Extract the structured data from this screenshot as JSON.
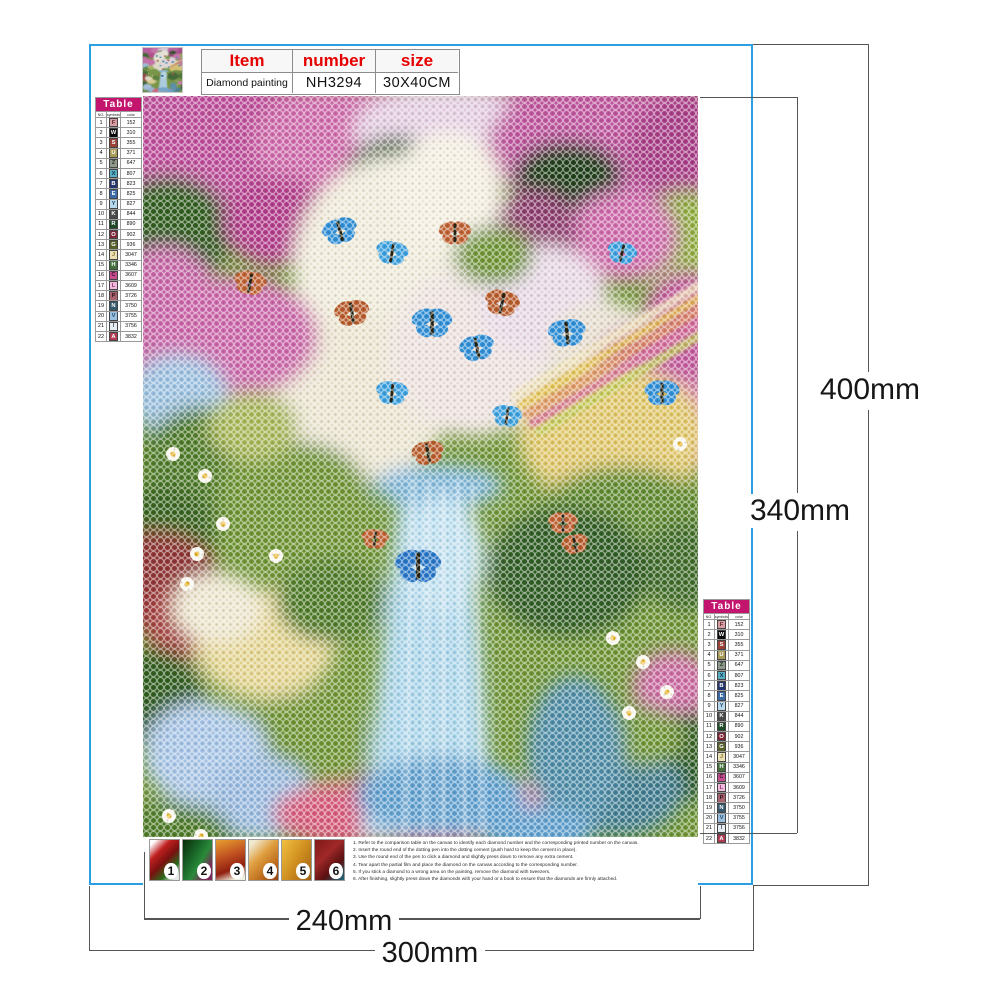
{
  "colors": {
    "border_blue": "#2b9fe2",
    "table_magenta": "#c4156e",
    "spec_red": "#e60000"
  },
  "spec_table": {
    "headers": {
      "item": "Item",
      "number": "number",
      "size": "size"
    },
    "values": {
      "item": "Diamond painting",
      "number": "NH3294",
      "size": "30X40CM"
    }
  },
  "color_table": {
    "title": "Table",
    "col_headers": {
      "no": "NO.",
      "symbols": "symbols",
      "color": "color"
    },
    "rows": [
      {
        "no": "1",
        "symbol": "F",
        "code": "152",
        "bg": "#d89ea4",
        "fg": "#5d2a32"
      },
      {
        "no": "2",
        "symbol": "W",
        "code": "310",
        "bg": "#0a0a0a",
        "fg": "#ffffff"
      },
      {
        "no": "3",
        "symbol": "S",
        "code": "355",
        "bg": "#9a4238",
        "fg": "#ffffff"
      },
      {
        "no": "4",
        "symbol": "U",
        "code": "371",
        "bg": "#a89a55",
        "fg": "#ffffff"
      },
      {
        "no": "5",
        "symbol": "Z",
        "code": "647",
        "bg": "#8f9a8c",
        "fg": "#2f3a2f"
      },
      {
        "no": "6",
        "symbol": "X",
        "code": "807",
        "bg": "#58aec2",
        "fg": "#123a52"
      },
      {
        "no": "7",
        "symbol": "B",
        "code": "823",
        "bg": "#24356b",
        "fg": "#ffffff"
      },
      {
        "no": "8",
        "symbol": "E",
        "code": "825",
        "bg": "#3a6aa8",
        "fg": "#ffffff"
      },
      {
        "no": "9",
        "symbol": "Y",
        "code": "827",
        "bg": "#b8d8ec",
        "fg": "#2a4a6a"
      },
      {
        "no": "10",
        "symbol": "K",
        "code": "844",
        "bg": "#4a4a4a",
        "fg": "#ffffff"
      },
      {
        "no": "11",
        "symbol": "R",
        "code": "890",
        "bg": "#1e4a28",
        "fg": "#ffffff"
      },
      {
        "no": "12",
        "symbol": "O",
        "code": "902",
        "bg": "#7e2638",
        "fg": "#ffffff"
      },
      {
        "no": "13",
        "symbol": "G",
        "code": "936",
        "bg": "#55622a",
        "fg": "#ffffff"
      },
      {
        "no": "14",
        "symbol": "J",
        "code": "3047",
        "bg": "#eadfb2",
        "fg": "#8a7a3a"
      },
      {
        "no": "15",
        "symbol": "H",
        "code": "3346",
        "bg": "#44703c",
        "fg": "#ffffff"
      },
      {
        "no": "16",
        "symbol": "C",
        "code": "3607",
        "bg": "#c84e92",
        "fg": "#3a1028"
      },
      {
        "no": "17",
        "symbol": "L",
        "code": "3609",
        "bg": "#f2b8dc",
        "fg": "#8a3a6a"
      },
      {
        "no": "18",
        "symbol": "P",
        "code": "3726",
        "bg": "#a86270",
        "fg": "#2f161c"
      },
      {
        "no": "19",
        "symbol": "N",
        "code": "3750",
        "bg": "#35596e",
        "fg": "#ffffff"
      },
      {
        "no": "20",
        "symbol": "V",
        "code": "3755",
        "bg": "#9cc0e0",
        "fg": "#23486a"
      },
      {
        "no": "21",
        "symbol": "I",
        "code": "3756",
        "bg": "#e6eef4",
        "fg": "#555566"
      },
      {
        "no": "22",
        "symbol": "A",
        "code": "3832",
        "bg": "#b03a52",
        "fg": "#ffffff"
      }
    ]
  },
  "dimensions": {
    "outer_height": "400mm",
    "inner_height": "340mm",
    "inner_width": "240mm",
    "outer_width": "300mm"
  },
  "steps": [
    "1",
    "2",
    "3",
    "4",
    "5",
    "6"
  ],
  "instructions": [
    "1. Refer to the comparison table on the canvas to identify each diamond number and the corresponding printed number on the canvas.",
    "2. Insert the round end of the dotting pen into the dotting cement (push hard to keep the cement in place).",
    "3. Use the round end of the pen to click a diamond and slightly press down to remove any extra cement.",
    "4. Tear apart the partial film and place the diamond on the canvas according to the corresponding number.",
    "5. If you stick a diamond to a wrong area on the painting, remove the diamond with tweezers.",
    "6. After finishing, slightly press down the diamonds with your hand or a book to ensure that the diamonds are firmly attached."
  ]
}
